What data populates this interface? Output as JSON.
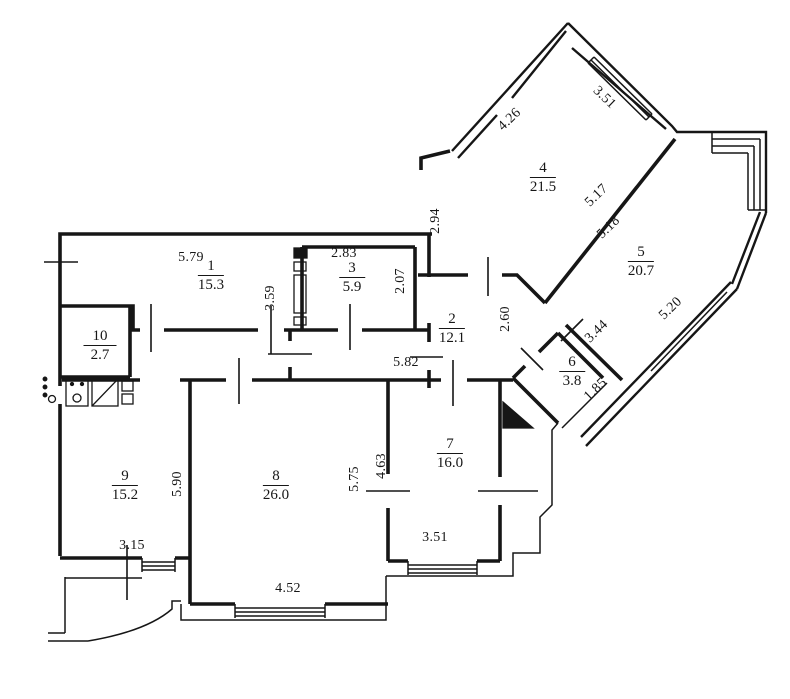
{
  "plan": {
    "kind": "apartment-floor-plan",
    "colors": {
      "line": "#161616",
      "background": "#ffffff"
    },
    "rooms": [
      {
        "number": "1",
        "area": "15.3",
        "x": 211,
        "y": 258
      },
      {
        "number": "2",
        "area": "12.1",
        "x": 452,
        "y": 311
      },
      {
        "number": "3",
        "area": "5.9",
        "x": 352,
        "y": 260
      },
      {
        "number": "4",
        "area": "21.5",
        "x": 543,
        "y": 160
      },
      {
        "number": "5",
        "area": "20.7",
        "x": 641,
        "y": 244
      },
      {
        "number": "6",
        "area": "3.8",
        "x": 572,
        "y": 354
      },
      {
        "number": "7",
        "area": "16.0",
        "x": 450,
        "y": 436
      },
      {
        "number": "8",
        "area": "26.0",
        "x": 276,
        "y": 468
      },
      {
        "number": "9",
        "area": "15.2",
        "x": 125,
        "y": 468
      },
      {
        "number": "10",
        "area": "2.7",
        "x": 100,
        "y": 328
      }
    ],
    "dimensions": [
      {
        "value": "5.79",
        "x": 191,
        "y": 258,
        "rot": 0
      },
      {
        "value": "2.83",
        "x": 344,
        "y": 254,
        "rot": 0
      },
      {
        "value": "3.59",
        "x": 271,
        "y": 298,
        "rot": -90
      },
      {
        "value": "2.07",
        "x": 401,
        "y": 281,
        "rot": -90
      },
      {
        "value": "2.94",
        "x": 436,
        "y": 221,
        "rot": -90
      },
      {
        "value": "4.26",
        "x": 510,
        "y": 120,
        "rot": -44
      },
      {
        "value": "3.51",
        "x": 604,
        "y": 98,
        "rot": 44
      },
      {
        "value": "5.17",
        "x": 597,
        "y": 196,
        "rot": -44
      },
      {
        "value": "5.18",
        "x": 609,
        "y": 228,
        "rot": -44
      },
      {
        "value": "5.20",
        "x": 671,
        "y": 309,
        "rot": -44
      },
      {
        "value": "3.44",
        "x": 597,
        "y": 332,
        "rot": -44
      },
      {
        "value": "2.60",
        "x": 506,
        "y": 319,
        "rot": -90
      },
      {
        "value": "5.82",
        "x": 406,
        "y": 363,
        "rot": 0
      },
      {
        "value": "1.85",
        "x": 596,
        "y": 390,
        "rot": -44
      },
      {
        "value": "4.63",
        "x": 382,
        "y": 466,
        "rot": -90
      },
      {
        "value": "3.51",
        "x": 435,
        "y": 538,
        "rot": 0
      },
      {
        "value": "5.75",
        "x": 355,
        "y": 479,
        "rot": -90
      },
      {
        "value": "5.90",
        "x": 178,
        "y": 484,
        "rot": -90
      },
      {
        "value": "3.15",
        "x": 132,
        "y": 546,
        "rot": 0
      },
      {
        "value": "4.52",
        "x": 288,
        "y": 589,
        "rot": 0
      }
    ]
  }
}
